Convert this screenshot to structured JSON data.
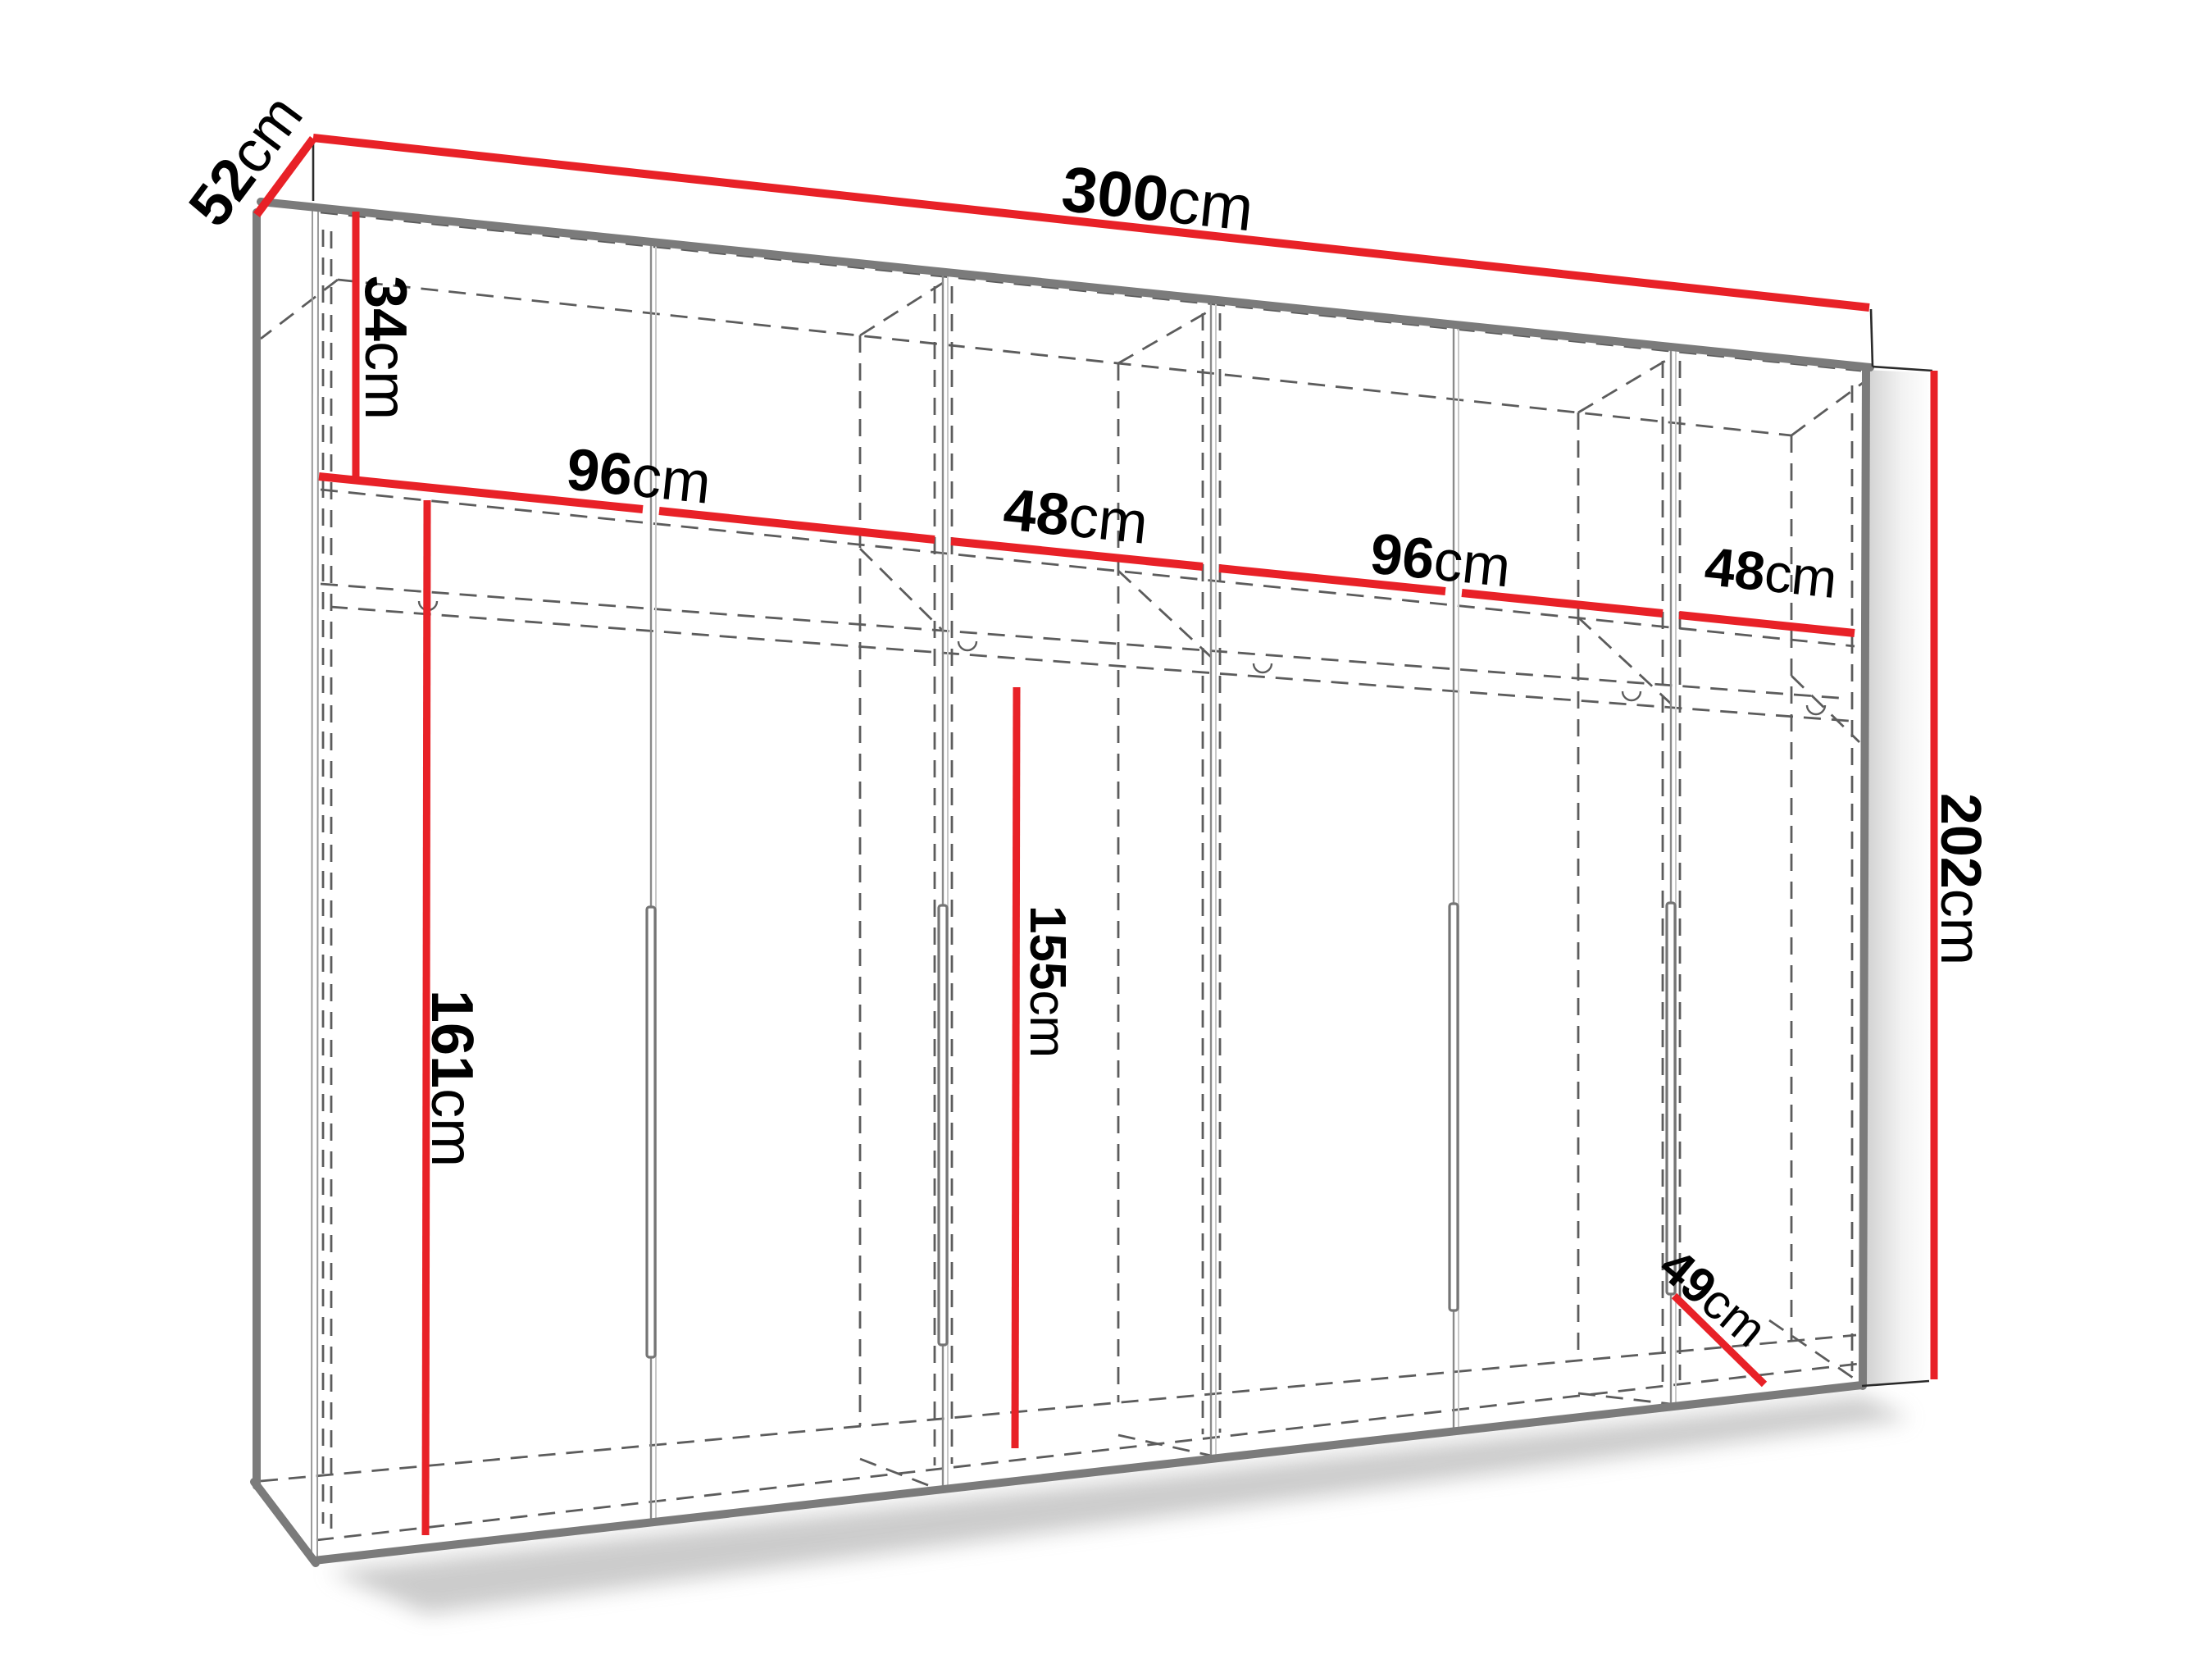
{
  "diagram": {
    "type": "wardrobe-dimension-diagram",
    "background": "#ffffff",
    "colors": {
      "dimension_line": "#e82127",
      "outline": "#2a2a2a",
      "edge_thick": "#7b7b7b",
      "hidden_line": "#5c5c5c"
    },
    "dimensions": {
      "width": {
        "value": "300",
        "unit": "cm"
      },
      "depth": {
        "value": "52",
        "unit": "cm"
      },
      "upper_section": {
        "value": "34",
        "unit": "cm"
      },
      "section_1_width": {
        "value": "96",
        "unit": "cm"
      },
      "section_2_width": {
        "value": "48",
        "unit": "cm"
      },
      "section_3_width": {
        "value": "96",
        "unit": "cm"
      },
      "section_4_width": {
        "value": "48",
        "unit": "cm"
      },
      "hanging_left": {
        "value": "161",
        "unit": "cm"
      },
      "hanging_middle": {
        "value": "155",
        "unit": "cm"
      },
      "total_height": {
        "value": "202",
        "unit": "cm"
      },
      "lower_depth": {
        "value": "49",
        "unit": "cm"
      }
    }
  }
}
